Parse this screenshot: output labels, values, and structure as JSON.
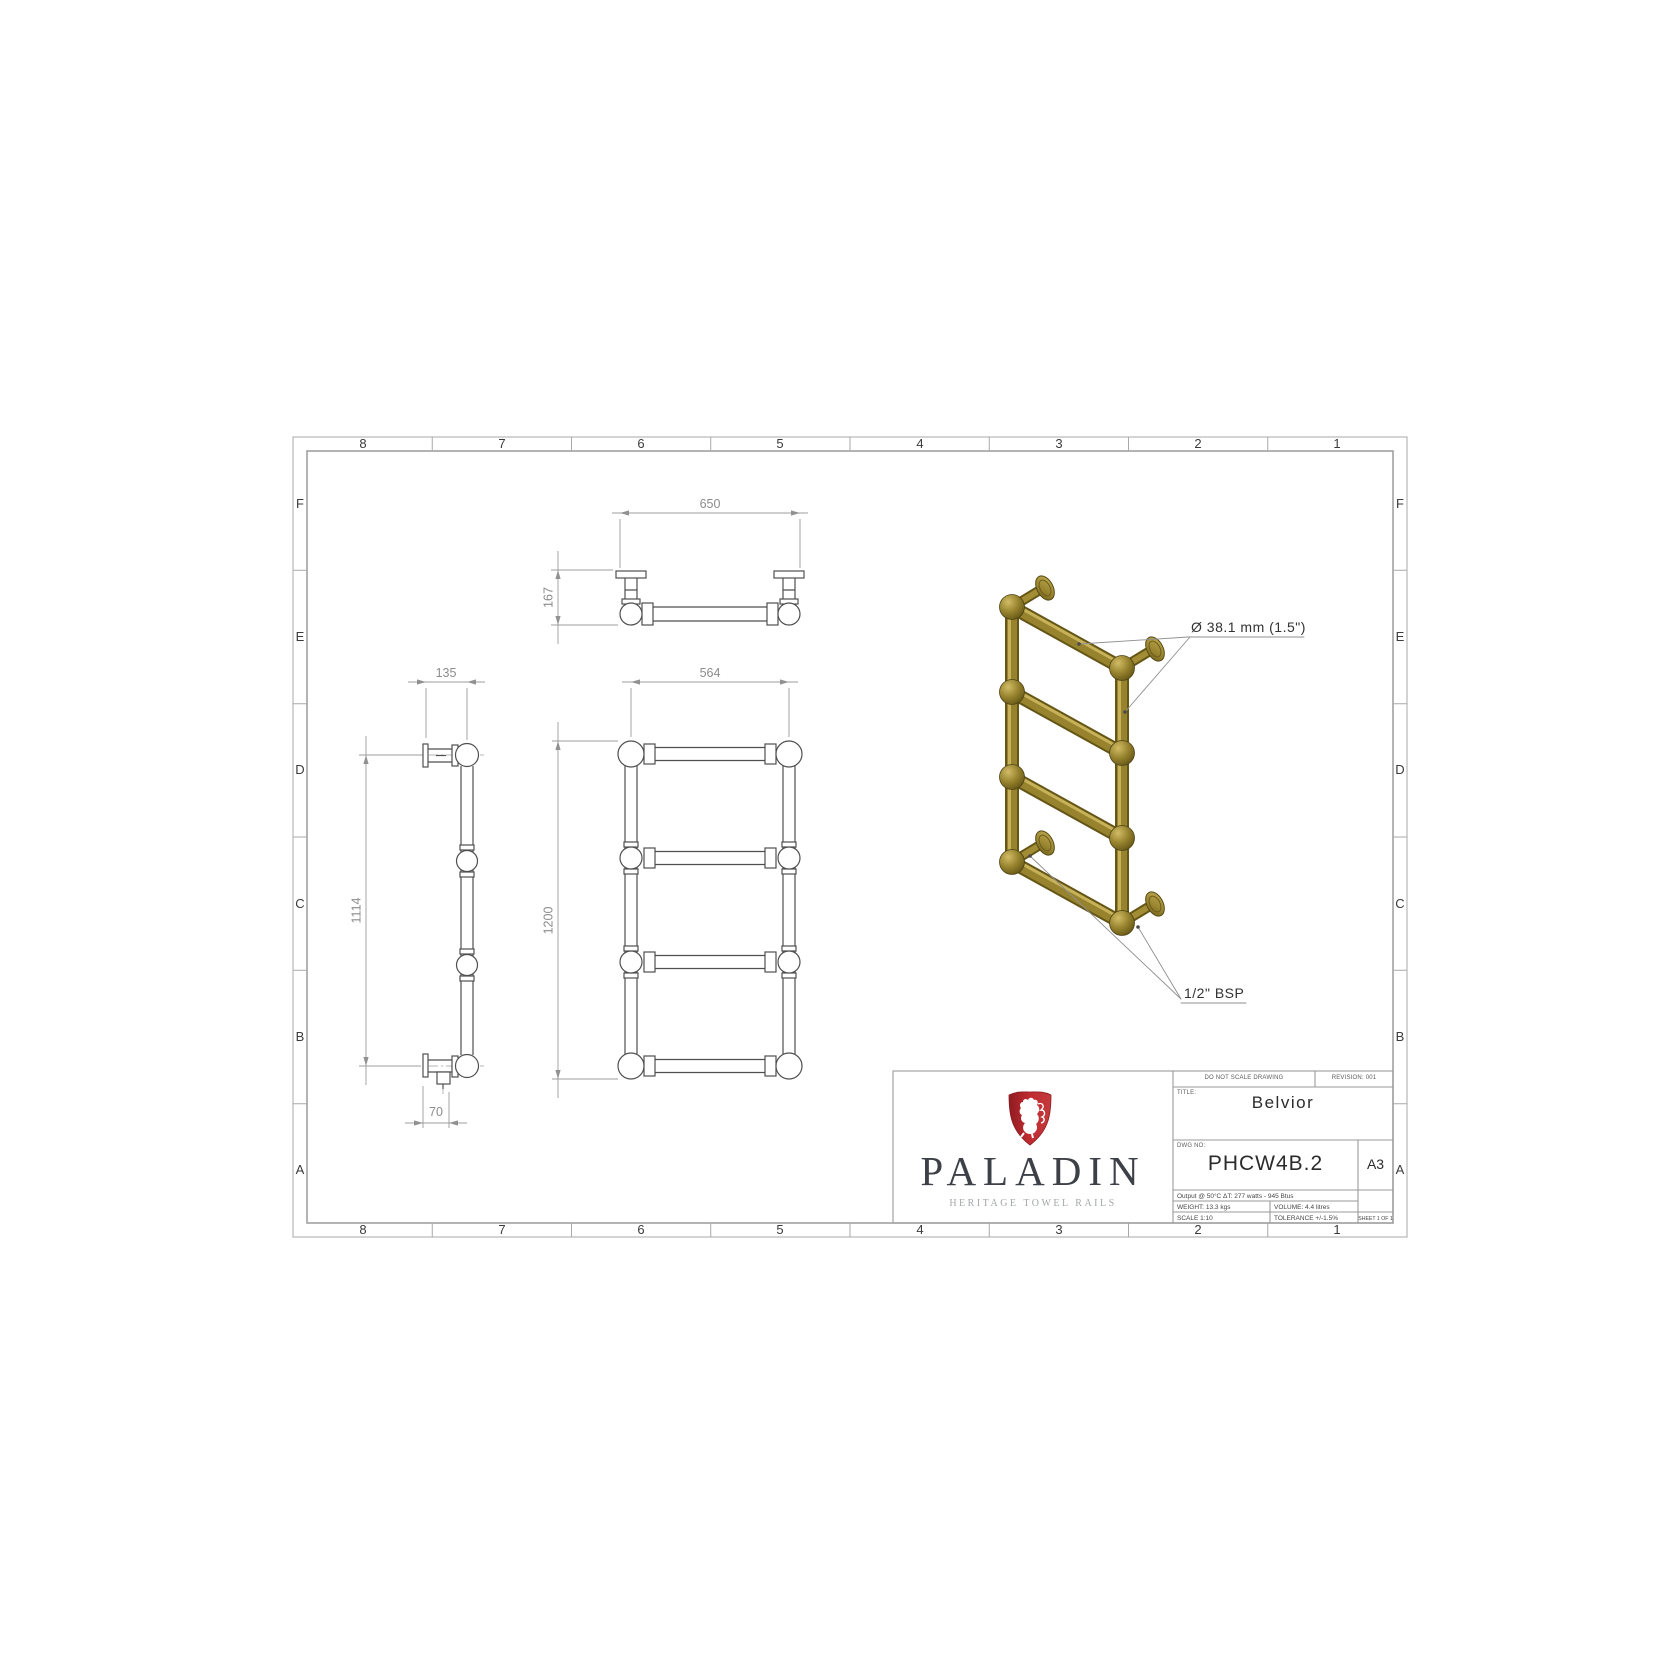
{
  "sheet": {
    "grid_columns": [
      "8",
      "7",
      "6",
      "5",
      "4",
      "3",
      "2",
      "1"
    ],
    "grid_rows": [
      "F",
      "E",
      "D",
      "C",
      "B",
      "A"
    ]
  },
  "dimensions": {
    "plan_width": "650",
    "plan_depth": "167",
    "front_width": "564",
    "front_height": "1200",
    "side_offset": "135",
    "side_height": "1114",
    "side_bottom": "70"
  },
  "annotations": {
    "tube_diameter": "Ø 38.1 mm (1.5\")",
    "connection": "1/2\" BSP"
  },
  "title_block": {
    "do_not_scale": "DO NOT SCALE DRAWING",
    "revision": "REVISION: 001",
    "title_label": "TITLE:",
    "title": "Belvior",
    "dwg_label": "DWG NO:",
    "dwg_no": "PHCW4B.2",
    "paper_size": "A3",
    "output": "Output @ 50°C ΔT: 277 watts - 945 Btus",
    "weight": "WEIGHT: 13.3 kgs",
    "volume": "VOLUME: 4.4 litres",
    "scale": "SCALE 1:10",
    "tolerance": "TOLERANCE +/-1.5%",
    "sheet": "SHEET 1 OF 1"
  },
  "logo": {
    "brand": "PALADIN",
    "tagline": "HERITAGE TOWEL RAILS"
  },
  "colors": {
    "accent_red": "#bb2a2e",
    "gold": "#97832e",
    "part_line": "#4f4f4f",
    "dim_line": "#9c9c9c"
  }
}
